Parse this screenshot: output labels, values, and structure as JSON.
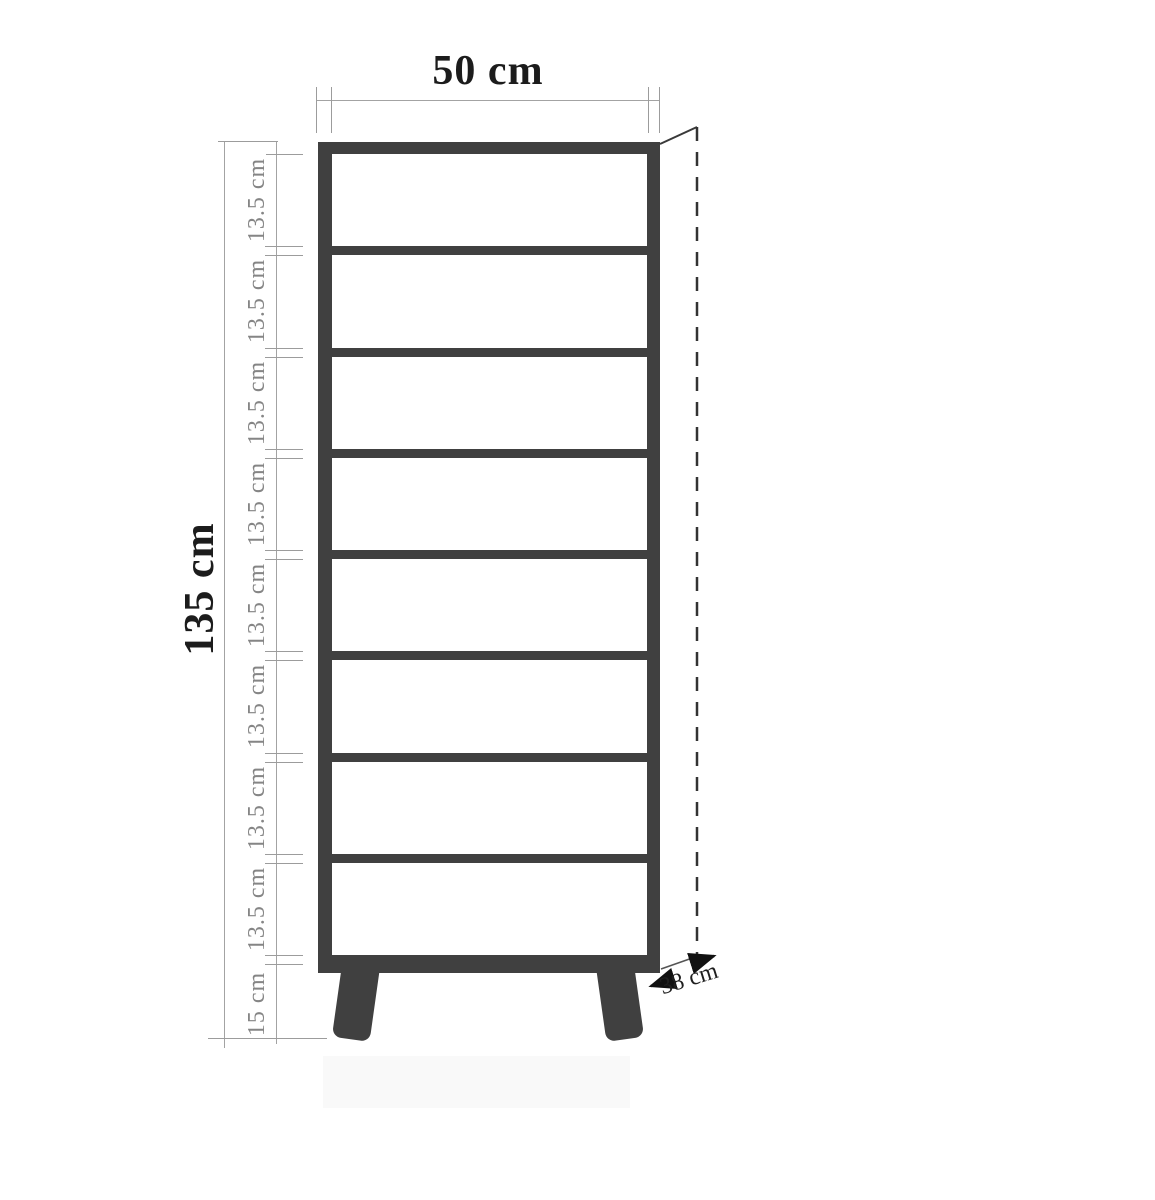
{
  "diagram": {
    "type": "furniture-dimension-drawing",
    "subject": "tall shelf cabinet with angled legs",
    "width_label": "50 cm",
    "height_label": "135 cm",
    "depth_label": "38 cm",
    "leg_height_label": "15 cm",
    "compartments": {
      "count": 8,
      "labels": [
        "13.5 cm",
        "13.5 cm",
        "13.5 cm",
        "13.5 cm",
        "13.5 cm",
        "13.5 cm",
        "13.5 cm",
        "13.5 cm"
      ]
    },
    "colors": {
      "frame": "#404040",
      "dimension_line": "#a3a3a3",
      "dimension_text_small": "#858585",
      "dimension_text_big": "#1c1c1c",
      "background": "#ffffff"
    }
  }
}
